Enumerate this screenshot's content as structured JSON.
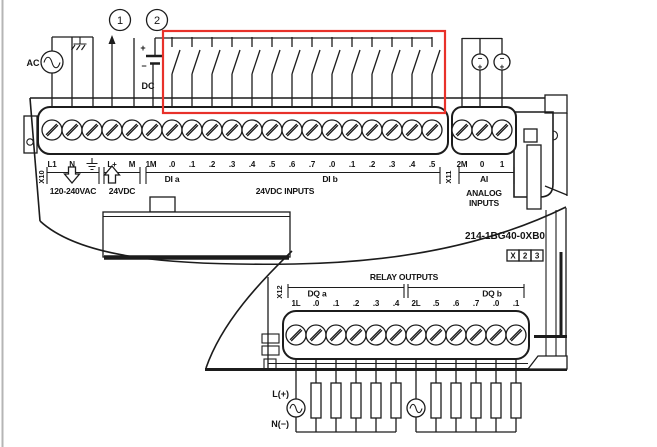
{
  "colors": {
    "ink": "#1c1c1c",
    "highlight_red": "#e8312a",
    "page_edge": "#b5b5b5"
  },
  "callouts": {
    "one": "1",
    "two": "2"
  },
  "top_left": {
    "ac_source": "AC",
    "dc_plus": "+",
    "dc_minus": "−",
    "dc_label": "DC"
  },
  "top_terminals": {
    "connector": "X10",
    "labels": [
      "L1",
      "N",
      "L+",
      "M",
      "1M",
      ".0",
      ".1",
      ".2",
      ".3",
      ".4",
      ".5",
      ".6",
      ".7",
      ".0",
      ".1",
      ".2",
      ".3",
      ".4",
      ".5"
    ],
    "mains_caption": "120-240VAC",
    "sensor_caption": "24VDC",
    "group_a": "DI a",
    "group_b": "DI b",
    "inputs_caption": "24VDC INPUTS"
  },
  "analog": {
    "connector": "X11",
    "labels": [
      "2M",
      "0",
      "1"
    ],
    "group": "AI",
    "caption1": "ANALOG",
    "caption2": "INPUTS",
    "src_minus": "−",
    "src_plus": "+"
  },
  "module": {
    "part_number": "214-1BG40-0XB0",
    "order_code": [
      "X",
      "2",
      "3"
    ]
  },
  "relay": {
    "connector": "X12",
    "title": "RELAY OUTPUTS",
    "group_a": "DQ a",
    "group_b": "DQ b",
    "labels": [
      "1L",
      ".0",
      ".1",
      ".2",
      ".3",
      ".4",
      "2L",
      ".5",
      ".6",
      ".7",
      ".0",
      ".1"
    ],
    "line_label": "L(+)",
    "neutral_label": "N(−)"
  }
}
